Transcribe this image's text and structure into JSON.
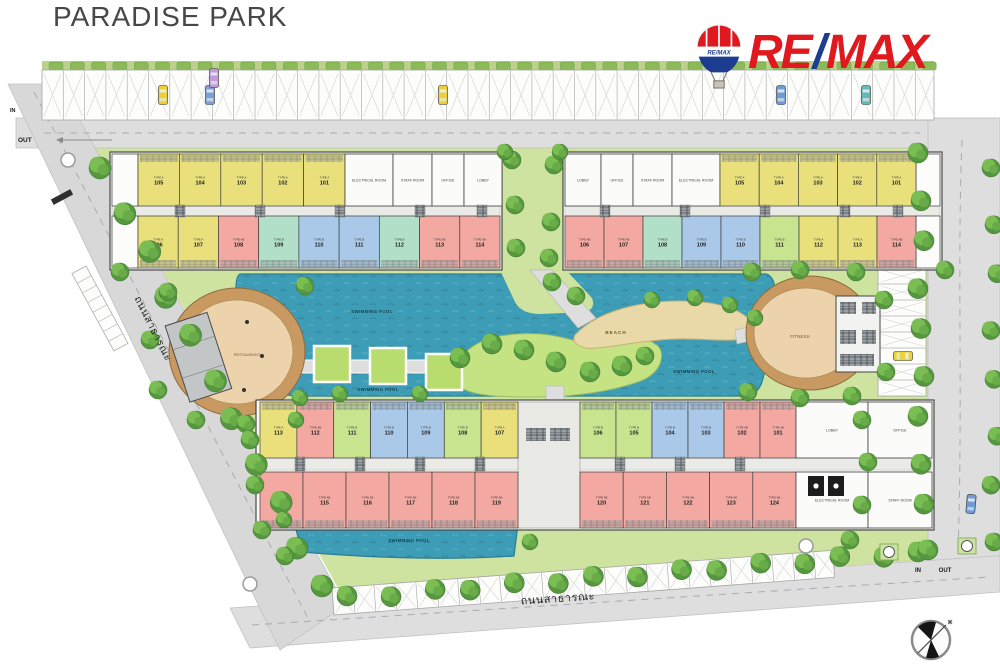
{
  "page": {
    "title": "PARADISE PARK"
  },
  "logo": {
    "re": "RE",
    "slash": "/",
    "max": "MAX",
    "balloon": "RE/MAX",
    "red": "#e0191f",
    "blue": "#1c3d8f"
  },
  "roads": {
    "left_name": "ถนนสาธารณะ",
    "bottom_name": "ถนนสาธารณะ",
    "in": "IN",
    "out": "OUT"
  },
  "labels": {
    "restaurant": "RESTAURANT",
    "fitness": "FITNESS",
    "beach": "BEACH",
    "swimming_pool": "SWIMMING POOL"
  },
  "palette": {
    "type_a_yellow": "#e9e07c",
    "type_ab_pink": "#f3a9a2",
    "type_b_blue": "#aac9e9",
    "type_b_teal": "#b2dfc8",
    "type_b_green": "#c9e48f",
    "water": "#3e9db6",
    "site_green": "#cfe3a0",
    "road_gray": "#dedede",
    "oval_tan": "#c89a62",
    "sand": "#ead9a8"
  },
  "buildings": {
    "top_left": {
      "top_units": [
        {
          "t": "TYPE A",
          "n": "105",
          "c": "yellow"
        },
        {
          "t": "TYPE A",
          "n": "104",
          "c": "yellow"
        },
        {
          "t": "TYPE A",
          "n": "103",
          "c": "yellow"
        },
        {
          "t": "TYPE A",
          "n": "102",
          "c": "yellow"
        },
        {
          "t": "TYPE A",
          "n": "101",
          "c": "yellow"
        }
      ],
      "top_rooms": [
        "ELECTRICAL ROOM",
        "STAFF ROOM",
        "OFFICE",
        "LOBBY"
      ],
      "bottom_units": [
        {
          "t": "TYPE A",
          "n": "106",
          "c": "yellow"
        },
        {
          "t": "TYPE A",
          "n": "107",
          "c": "yellow"
        },
        {
          "t": "TYPE AB",
          "n": "108",
          "c": "pink"
        },
        {
          "t": "TYPE B",
          "n": "109",
          "c": "teal"
        },
        {
          "t": "TYPE B",
          "n": "110",
          "c": "blue"
        },
        {
          "t": "TYPE B",
          "n": "111",
          "c": "blue"
        },
        {
          "t": "TYPE B",
          "n": "112",
          "c": "teal"
        },
        {
          "t": "TYPE AB",
          "n": "113",
          "c": "pink"
        },
        {
          "t": "TYPE AB",
          "n": "114",
          "c": "pink"
        }
      ]
    },
    "top_right": {
      "top_rooms": [
        "LOBBY",
        "OFFICE",
        "STAFF ROOM",
        "ELECTRICAL ROOM"
      ],
      "top_units": [
        {
          "t": "TYPE A",
          "n": "105",
          "c": "yellow"
        },
        {
          "t": "TYPE A",
          "n": "104",
          "c": "yellow"
        },
        {
          "t": "TYPE A",
          "n": "103",
          "c": "yellow"
        },
        {
          "t": "TYPE A",
          "n": "102",
          "c": "yellow"
        },
        {
          "t": "TYPE A",
          "n": "101",
          "c": "yellow"
        }
      ],
      "bottom_units": [
        {
          "t": "TYPE AB",
          "n": "106",
          "c": "pink"
        },
        {
          "t": "TYPE AB",
          "n": "107",
          "c": "pink"
        },
        {
          "t": "TYPE B",
          "n": "108",
          "c": "teal"
        },
        {
          "t": "TYPE B",
          "n": "109",
          "c": "blue"
        },
        {
          "t": "TYPE B",
          "n": "110",
          "c": "blue"
        },
        {
          "t": "TYPE B",
          "n": "111",
          "c": "green"
        },
        {
          "t": "TYPE A",
          "n": "112",
          "c": "yellow"
        },
        {
          "t": "TYPE A",
          "n": "113",
          "c": "yellow"
        },
        {
          "t": "TYPE AB",
          "n": "114",
          "c": "pink"
        }
      ]
    },
    "bottom": {
      "top_units_left": [
        {
          "t": "TYPE A",
          "n": "113",
          "c": "yellow"
        },
        {
          "t": "TYPE AB",
          "n": "112",
          "c": "pink"
        },
        {
          "t": "TYPE B",
          "n": "111",
          "c": "green"
        },
        {
          "t": "TYPE B",
          "n": "110",
          "c": "blue"
        },
        {
          "t": "TYPE B",
          "n": "109",
          "c": "blue"
        },
        {
          "t": "TYPE B",
          "n": "108",
          "c": "green"
        },
        {
          "t": "TYPE A",
          "n": "107",
          "c": "yellow"
        }
      ],
      "top_units_right": [
        {
          "t": "TYPE B",
          "n": "106",
          "c": "green"
        },
        {
          "t": "TYPE B",
          "n": "105",
          "c": "green"
        },
        {
          "t": "TYPE B",
          "n": "104",
          "c": "blue"
        },
        {
          "t": "TYPE B",
          "n": "103",
          "c": "blue"
        },
        {
          "t": "TYPE AB",
          "n": "102",
          "c": "pink"
        },
        {
          "t": "TYPE AB",
          "n": "101",
          "c": "pink"
        }
      ],
      "top_rooms": [
        "LOBBY",
        "OFFICE"
      ],
      "bottom_units_left": [
        {
          "t": "TYPE AB",
          "n": "114",
          "c": "pink"
        },
        {
          "t": "TYPE AB",
          "n": "115",
          "c": "pink"
        },
        {
          "t": "TYPE AB",
          "n": "116",
          "c": "pink"
        },
        {
          "t": "TYPE AB",
          "n": "117",
          "c": "pink"
        },
        {
          "t": "TYPE AB",
          "n": "118",
          "c": "pink"
        },
        {
          "t": "TYPE AB",
          "n": "119",
          "c": "pink"
        }
      ],
      "bottom_units_right": [
        {
          "t": "TYPE AB",
          "n": "120",
          "c": "pink"
        },
        {
          "t": "TYPE AB",
          "n": "121",
          "c": "pink"
        },
        {
          "t": "TYPE AB",
          "n": "122",
          "c": "pink"
        },
        {
          "t": "TYPE AB",
          "n": "123",
          "c": "pink"
        },
        {
          "t": "TYPE AB",
          "n": "124",
          "c": "pink"
        }
      ],
      "bottom_rooms": [
        "ELECTRICAL ROOM",
        "STAFF ROOM"
      ]
    }
  }
}
